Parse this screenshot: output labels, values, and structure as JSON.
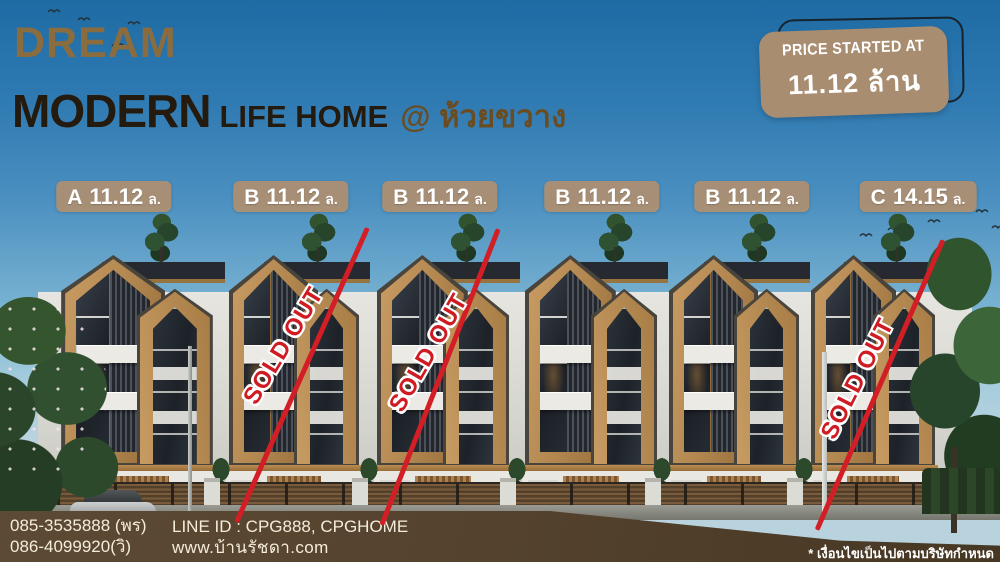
{
  "title": {
    "brand": "DREAM",
    "main": "MODERN",
    "sub": "LIFE HOME",
    "location": "@ ห้วยขวาง"
  },
  "price_badge": {
    "caption": "PRICE STARTED AT",
    "value": "11.12 ล้าน"
  },
  "sold_out_label": "SOLD OUT",
  "buildings": [
    {
      "unit": "A",
      "price": "11.12",
      "suffix": "ล.",
      "sold_out": false
    },
    {
      "unit": "B",
      "price": "11.12",
      "suffix": "ล.",
      "sold_out": true
    },
    {
      "unit": "B",
      "price": "11.12",
      "suffix": "ล.",
      "sold_out": true
    },
    {
      "unit": "B",
      "price": "11.12",
      "suffix": "ล.",
      "sold_out": false
    },
    {
      "unit": "B",
      "price": "11.12",
      "suffix": "ล.",
      "sold_out": false
    },
    {
      "unit": "C",
      "price": "14.15",
      "suffix": "ล.",
      "sold_out": true
    }
  ],
  "contact": {
    "phone1": "085-3535888 (พร)",
    "phone2": "086-4099920(วิ)",
    "line_id": "LINE ID : CPG888, CPGHOME",
    "website": "www.บ้านรัชดา.com"
  },
  "disclaimer": "* เงื่อนไขเป็นไปตามบริษัทกำหนด",
  "colors": {
    "accent_red": "#d31e26",
    "badge_tan": "#a98d70",
    "brand_gold": "#8a6c3f",
    "title_dark": "#241a0e",
    "bar_brown": "#54422e"
  }
}
